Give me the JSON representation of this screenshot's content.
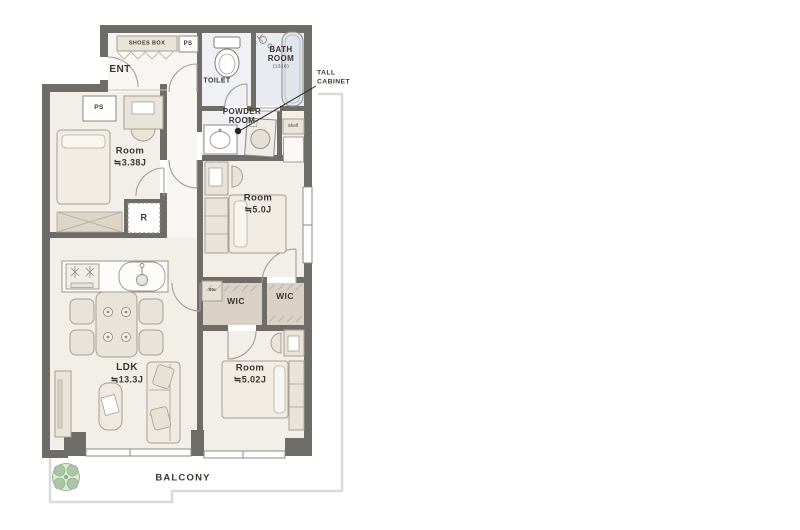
{
  "colors": {
    "wall": "#6f6b67",
    "floor": "#f2efe9",
    "wet": "#eff1f4",
    "bath": "#e8ecf2",
    "closet": "#d9d1c5",
    "furniture": "#e9e4d9",
    "furnitureLight": "#f0ece3",
    "outline": "#a59e93",
    "balconyLine": "#dcdad7",
    "plantFill": "#dcead8",
    "plantLeaf": "#abc7a5",
    "text": "#3a3733",
    "ink": "#26231f"
  },
  "plan": {
    "entry": {
      "ent": "ENT",
      "shoes_box": "SHOES BOX",
      "ps": "PS"
    },
    "sanitary": {
      "toilet": "TOILET",
      "bath_name_line1": "BATH",
      "bath_name_line2": "ROOM",
      "bath_size": "(1316)",
      "powder_line1": "POWDER",
      "powder_line2": "ROOM",
      "tall_cabinet_line1": "TALL",
      "tall_cabinet_line2": "CABINET",
      "shelf": "Shelf"
    },
    "rooms": {
      "bedroom1": {
        "name": "Room",
        "size": "≒3.38J",
        "ps": "PS"
      },
      "bedroom2": {
        "name": "Room",
        "size": "≒5.0J"
      },
      "bedroom3": {
        "name": "Room",
        "size": "≒5.02J"
      },
      "ldk": {
        "name": "LDK",
        "size": "≒13.3J",
        "fridge": "R"
      }
    },
    "storage": {
      "sto": "Sto",
      "wic_left": "WIC",
      "wic_right": "WIC"
    },
    "outdoor": {
      "balcony": "BALCONY"
    }
  }
}
